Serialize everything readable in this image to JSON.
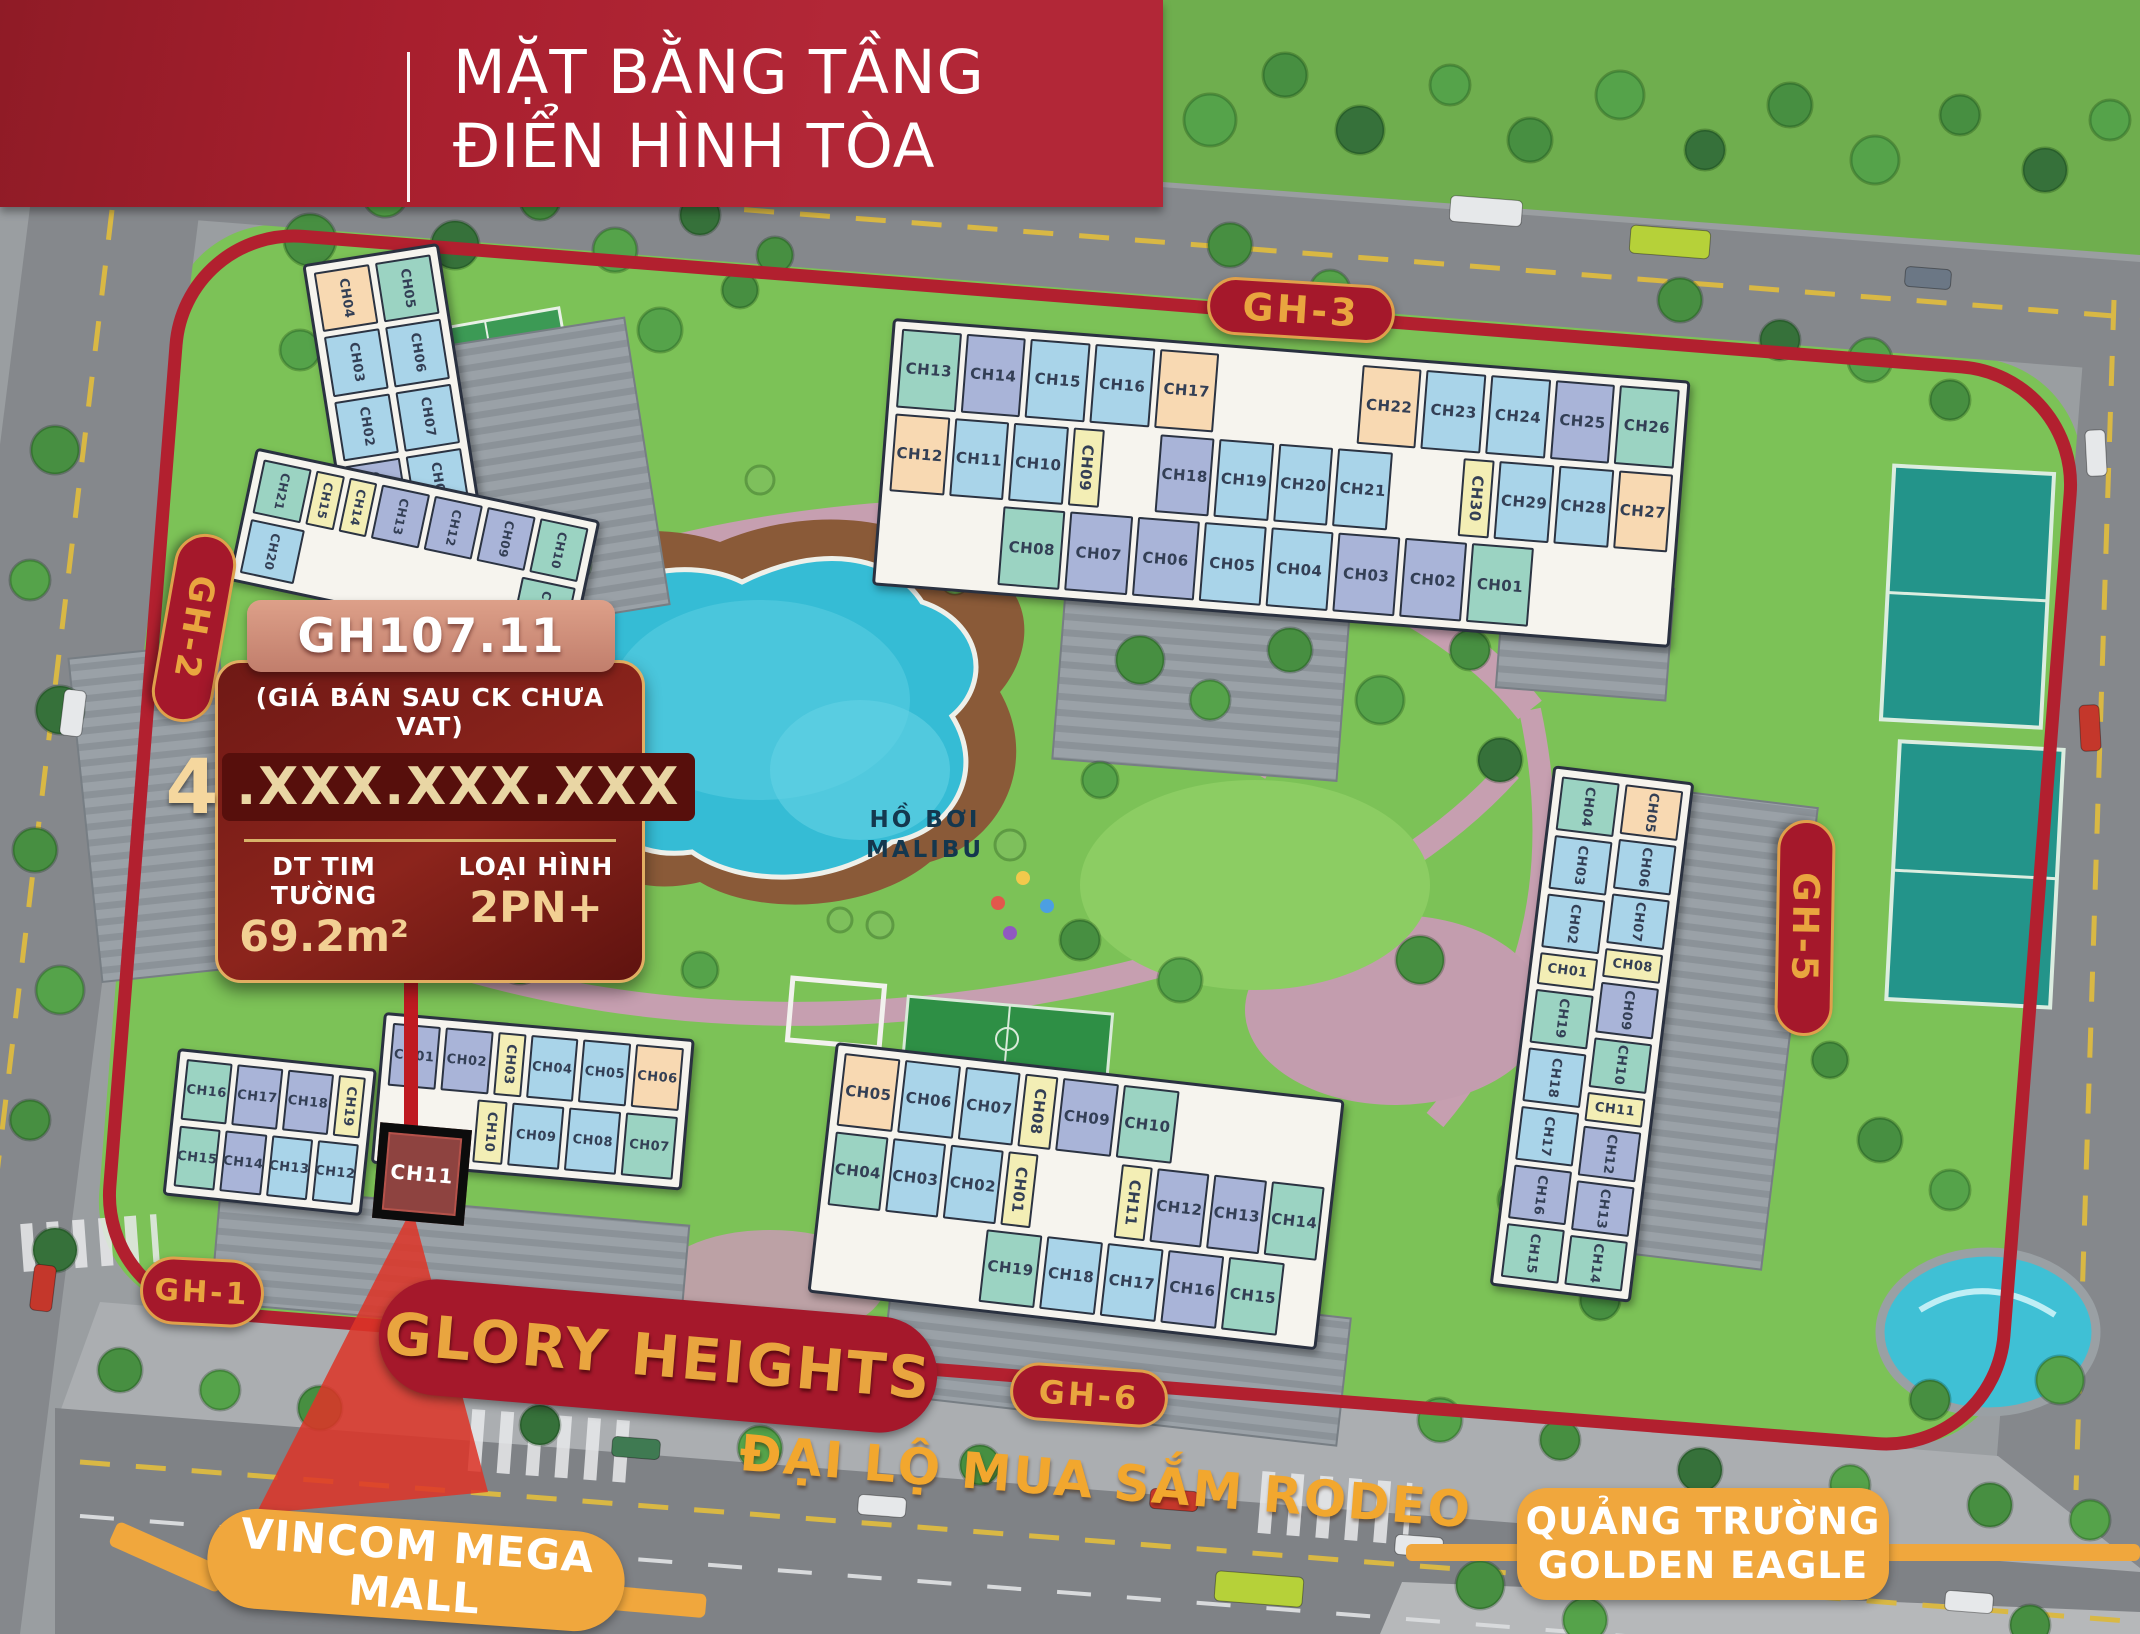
{
  "header": {
    "title_line1": "MẶT BẰNG TẦNG",
    "title_line2": "ĐIỂN HÌNH TÒA"
  },
  "info_card": {
    "unit_code": "GH107.11",
    "price_note": "(GIÁ BÁN SAU CK CHƯA VAT)",
    "price_lead": "4",
    "price_masked": ".XXX.XXX.XXX",
    "area_label": "DT TIM TƯỜNG",
    "area_value": "69.2m²",
    "type_label": "LOẠI HÌNH",
    "type_value": "2PN+"
  },
  "labels": {
    "gh1": "GH-1",
    "gh2": "GH-2",
    "gh3": "GH-3",
    "gh5": "GH-5",
    "gh6": "GH-6",
    "project": "GLORY HEIGHTS",
    "boulevard": "ĐẠI LỘ MUA SẮM RODEO",
    "mall": "VINCOM MEGA MALL",
    "square1": "QUẢNG TRƯỜNG",
    "square2": "GOLDEN EAGLE",
    "pool1": "HỒ BƠI",
    "pool2": "MALIBU"
  },
  "palette": {
    "teal": "#9bd3c2",
    "blue": "#a9d4e9",
    "lavender": "#a9b4d8",
    "peach": "#f8d9b2",
    "yellow": "#f3eeb5",
    "highlight": "#8e4340",
    "boundary_red": "#b2202f",
    "pill_red": "#a5182b",
    "gold": "#e9a53f",
    "orange": "#f0a73d"
  },
  "highlight": {
    "unit": "CH11"
  },
  "buildings": {
    "gh2_upper": {
      "col_left": [
        {
          "id": "CH04",
          "c": "peach"
        },
        {
          "id": "CH03",
          "c": "blue"
        },
        {
          "id": "CH02",
          "c": "blue"
        },
        {
          "id": "CH01",
          "c": "lavender"
        }
      ],
      "col_right": [
        {
          "id": "CH05",
          "c": "teal"
        },
        {
          "id": "CH06",
          "c": "blue"
        },
        {
          "id": "CH07",
          "c": "blue"
        },
        {
          "id": "CH08",
          "c": "blue"
        }
      ]
    },
    "gh2_lower": {
      "row1": [
        {
          "id": "CH21",
          "c": "teal"
        },
        {
          "id": "CH15",
          "c": "yellow",
          "n": true
        },
        {
          "id": "CH14",
          "c": "yellow",
          "n": true
        },
        {
          "id": "CH13",
          "c": "lavender"
        },
        {
          "id": "CH12",
          "c": "lavender"
        },
        {
          "id": "CH09",
          "c": "lavender"
        },
        {
          "id": "CH10",
          "c": "teal"
        }
      ],
      "row2": [
        {
          "id": "CH20",
          "c": "blue"
        },
        {
          "gap": 4.2
        },
        {
          "id": "CH11",
          "c": "teal"
        }
      ]
    },
    "gh3": {
      "row1": [
        {
          "id": "CH13",
          "c": "teal"
        },
        {
          "id": "CH14",
          "c": "lavender"
        },
        {
          "id": "CH15",
          "c": "blue"
        },
        {
          "id": "CH16",
          "c": "blue"
        },
        {
          "id": "CH17",
          "c": "peach"
        },
        {
          "gap": 2.4
        },
        {
          "id": "CH22",
          "c": "peach"
        },
        {
          "id": "CH23",
          "c": "blue"
        },
        {
          "id": "CH24",
          "c": "blue"
        },
        {
          "id": "CH25",
          "c": "lavender"
        },
        {
          "id": "CH26",
          "c": "teal"
        }
      ],
      "row2": [
        {
          "id": "CH12",
          "c": "peach"
        },
        {
          "id": "CH11",
          "c": "blue"
        },
        {
          "id": "CH10",
          "c": "blue"
        },
        {
          "id": "CH09",
          "c": "yellow",
          "n": true
        },
        {
          "gap": 0.9
        },
        {
          "id": "CH18",
          "c": "lavender"
        },
        {
          "id": "CH19",
          "c": "blue"
        },
        {
          "id": "CH20",
          "c": "blue"
        },
        {
          "id": "CH21",
          "c": "blue"
        },
        {
          "gap": 1.2
        },
        {
          "id": "CH30",
          "c": "yellow",
          "n": true
        },
        {
          "id": "CH29",
          "c": "blue"
        },
        {
          "id": "CH28",
          "c": "blue"
        },
        {
          "id": "CH27",
          "c": "peach"
        }
      ],
      "row3": [
        {
          "gap": 1.9
        },
        {
          "id": "CH08",
          "c": "teal"
        },
        {
          "id": "CH07",
          "c": "lavender"
        },
        {
          "id": "CH06",
          "c": "lavender"
        },
        {
          "id": "CH05",
          "c": "blue"
        },
        {
          "id": "CH04",
          "c": "blue"
        },
        {
          "id": "CH03",
          "c": "lavender"
        },
        {
          "id": "CH02",
          "c": "lavender"
        },
        {
          "id": "CH01",
          "c": "teal"
        },
        {
          "gap": 2.2
        }
      ]
    },
    "gh5": {
      "col_left": [
        {
          "id": "CH04",
          "c": "teal"
        },
        {
          "id": "CH03",
          "c": "blue"
        },
        {
          "id": "CH02",
          "c": "blue"
        },
        {
          "id": "CH01",
          "c": "yellow",
          "n": true
        },
        {
          "id": "CH19",
          "c": "teal"
        },
        {
          "id": "CH18",
          "c": "blue"
        },
        {
          "id": "CH17",
          "c": "blue"
        },
        {
          "id": "CH16",
          "c": "lavender"
        },
        {
          "id": "CH15",
          "c": "teal"
        }
      ],
      "col_right": [
        {
          "id": "CH05",
          "c": "peach"
        },
        {
          "id": "CH06",
          "c": "blue"
        },
        {
          "id": "CH07",
          "c": "blue"
        },
        {
          "id": "CH08",
          "c": "yellow",
          "n": true
        },
        {
          "id": "CH09",
          "c": "lavender"
        },
        {
          "id": "CH10",
          "c": "teal"
        },
        {
          "id": "CH11",
          "c": "yellow",
          "n": true
        },
        {
          "id": "CH12",
          "c": "lavender"
        },
        {
          "id": "CH13",
          "c": "lavender"
        },
        {
          "id": "CH14",
          "c": "teal"
        }
      ]
    },
    "gh1": {
      "left_row1": [
        {
          "id": "CH16",
          "c": "teal"
        },
        {
          "id": "CH17",
          "c": "lavender"
        },
        {
          "id": "CH18",
          "c": "lavender"
        },
        {
          "id": "CH19",
          "c": "yellow",
          "n": true
        }
      ],
      "left_row2": [
        {
          "id": "CH15",
          "c": "teal"
        },
        {
          "id": "CH14",
          "c": "lavender"
        },
        {
          "id": "CH13",
          "c": "blue"
        },
        {
          "id": "CH12",
          "c": "blue"
        }
      ],
      "right_row1": [
        {
          "id": "CH01",
          "c": "lavender"
        },
        {
          "id": "CH02",
          "c": "lavender"
        },
        {
          "id": "CH03",
          "c": "yellow",
          "n": true
        },
        {
          "id": "CH04",
          "c": "blue"
        },
        {
          "id": "CH05",
          "c": "blue"
        },
        {
          "id": "CH06",
          "c": "peach"
        }
      ],
      "right_row2": [
        {
          "gap": 1.8
        },
        {
          "id": "CH10",
          "c": "yellow",
          "n": true
        },
        {
          "id": "CH09",
          "c": "blue"
        },
        {
          "id": "CH08",
          "c": "blue"
        },
        {
          "id": "CH07",
          "c": "teal"
        }
      ]
    },
    "gh6": {
      "row1": [
        {
          "id": "CH05",
          "c": "peach"
        },
        {
          "id": "CH06",
          "c": "blue"
        },
        {
          "id": "CH07",
          "c": "blue"
        },
        {
          "id": "CH08",
          "c": "yellow",
          "n": true
        },
        {
          "id": "CH09",
          "c": "lavender"
        },
        {
          "id": "CH10",
          "c": "teal"
        },
        {
          "gap": 2.9
        }
      ],
      "row2": [
        {
          "id": "CH04",
          "c": "teal"
        },
        {
          "id": "CH03",
          "c": "blue"
        },
        {
          "id": "CH02",
          "c": "blue"
        },
        {
          "id": "CH01",
          "c": "yellow",
          "n": true
        },
        {
          "gap": 1.5
        },
        {
          "id": "CH11",
          "c": "yellow",
          "n": true
        },
        {
          "id": "CH12",
          "c": "lavender"
        },
        {
          "id": "CH13",
          "c": "lavender"
        },
        {
          "id": "CH14",
          "c": "teal"
        }
      ],
      "row3": [
        {
          "gap": 3.0
        },
        {
          "id": "CH19",
          "c": "teal"
        },
        {
          "id": "CH18",
          "c": "blue"
        },
        {
          "id": "CH17",
          "c": "blue"
        },
        {
          "id": "CH16",
          "c": "lavender"
        },
        {
          "id": "CH15",
          "c": "teal"
        },
        {
          "gap": 0.5
        }
      ]
    }
  }
}
